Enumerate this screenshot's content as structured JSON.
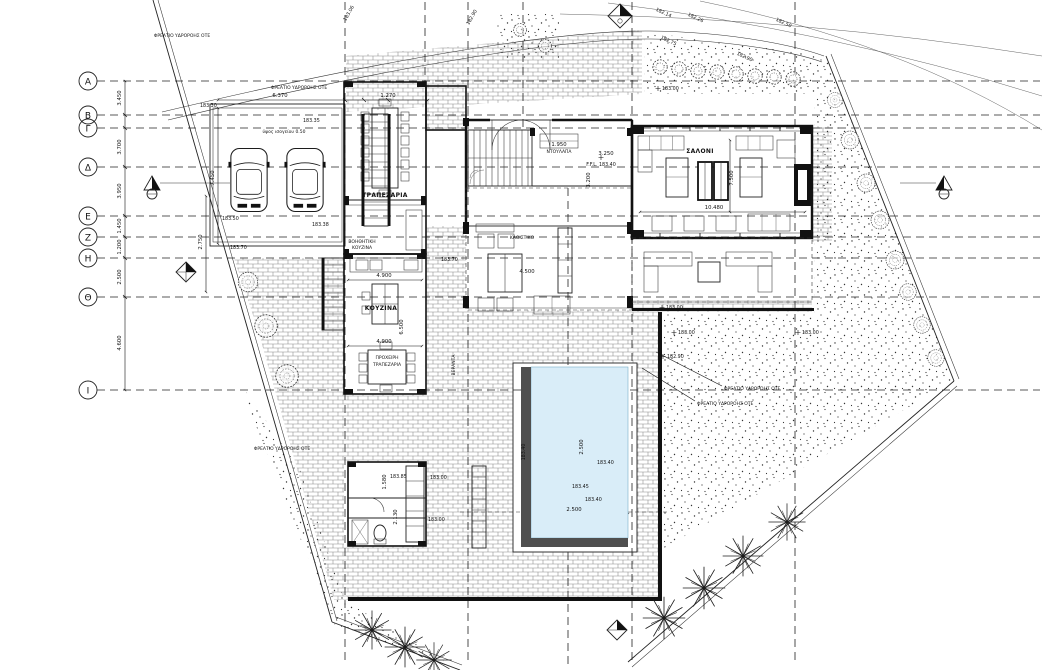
{
  "drawing": {
    "type": "villa-ground-floor-site-plan",
    "grid_rows": {
      "r1": "Α",
      "r2": "Β",
      "r3": "Γ",
      "r4": "Δ",
      "r5": "Ε",
      "r6": "Ζ",
      "r7": "Η",
      "r8": "Θ",
      "r9": "Ι"
    },
    "rooms": {
      "dining": "ΤΡΑΠΕΖΑΡΙΑ",
      "aux_kitchen_line1": "ΒΟΗΘΗΤΙΚΗ",
      "aux_kitchen_line2": "ΚΟΥΖΙΝΑ",
      "kitchen": "ΚΟΥΖΙΝΑ",
      "casual_line1": "ΠΡΟΧΕΙΡΗ",
      "casual_line2": "ΤΡΑΠΕΖΑΡΙΑ",
      "living": "ΣΑΛΟΝΙ",
      "sitting": "ΚΑΘΙΣΤΙΚΟ",
      "veranda": "ΒΕΡΑΝΤΑ",
      "wardrobe": "ΝΤΟΥΛΑΠΑ"
    },
    "notes": {
      "drain": "ΦΡΕΑΤΙΟ ΥΔΡΟΡΟΗΣ ΟΤΕ",
      "ground_height": "ύψος ισογείου 0.50",
      "ffl": "F.F.L. 183.40"
    },
    "dims": {
      "top_width": "6.370",
      "stair_width": "1.270",
      "parking_depth": "7.450",
      "ramp_depth": "2.750",
      "row_ab": "3.450",
      "row_gd": "3.700",
      "row_de": "3.950",
      "row_ez": "1.450",
      "row_zh": "1.200",
      "row_hth": "2.500",
      "row_thi": "4.600",
      "kitchen_top": "4.900",
      "kitchen_bottom": "4.900",
      "kitchen_len": "6.500",
      "sitting": "4.500",
      "living_width": "10.480",
      "living_depth": "7.500",
      "hall_a": "3.250",
      "hall_b": "3.200",
      "closet": "1.950",
      "pool_a": "2.500",
      "pool_b": "2.500",
      "util_a": "1.580",
      "util_b": "2.130"
    },
    "levels": {
      "p1": "183.30",
      "p2": "183.35",
      "p3": "183.38",
      "p4": "183.50",
      "p5": "183.70",
      "p6": "183.85",
      "pool1": "183.40",
      "pool2": "183.45",
      "pool3": "183.40",
      "pool4": "183.40",
      "e1": "183.00",
      "e2": "183.00",
      "e3": "182.90",
      "e4": "183.00",
      "e5": "183.00",
      "b1": "183.70",
      "b2": "183.00",
      "b3": "183.00"
    },
    "contours": {
      "c1": "182.14",
      "c2": "182.26",
      "c3": "182.50",
      "c4": "182.75",
      "c5": "182.90",
      "c6": "183.06"
    },
    "colors": {
      "pool_water": "#d9edf8",
      "deck": "#4f4f4f",
      "blue_text": "#3a56c4",
      "line": "#111111"
    }
  }
}
